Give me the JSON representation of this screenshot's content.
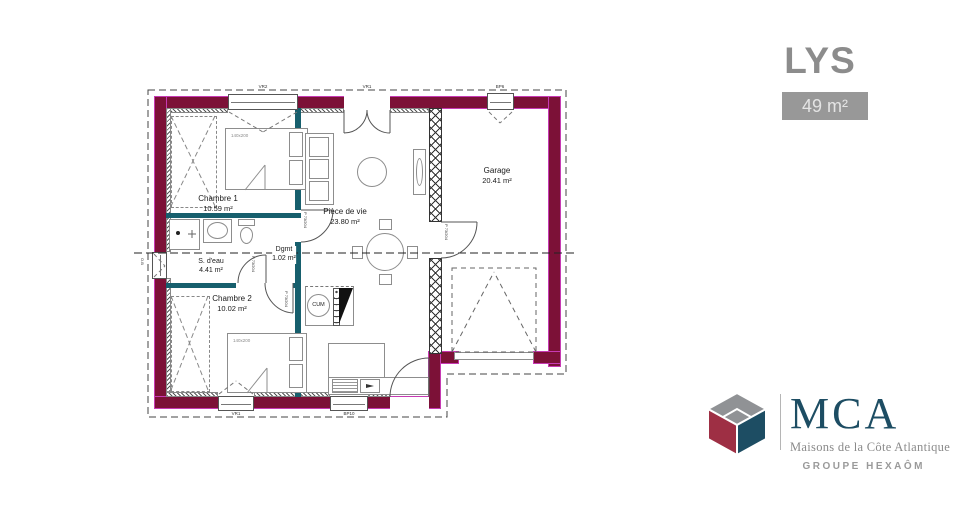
{
  "header": {
    "title": "LYS",
    "area_badge": "49 m²"
  },
  "plan": {
    "rooms": [
      {
        "name": "Chambre 1",
        "area": "10.59 m²"
      },
      {
        "name": "Pièce de vie",
        "area": "23.80 m²"
      },
      {
        "name": "Garage",
        "area": "20.41 m²"
      },
      {
        "name": "S. d'eau",
        "area": "4.41 m²"
      },
      {
        "name": "Dgmt",
        "area": "1.02 m²"
      },
      {
        "name": "Chambre 2",
        "area": "10.02 m²"
      }
    ],
    "door_code": "P 73/204",
    "bed_size": "140x200",
    "water_heater_label": "CUM",
    "window_codes": {
      "bedroom1_top": "VR2",
      "living_top": "VR1",
      "garage_top": "BP6",
      "bedroom2_bottom": "VR1",
      "kitchen_bottom": "BP10",
      "bathroom_left": "O.B"
    }
  },
  "brand": {
    "name": "MCA",
    "tagline": "Maisons de la Côte Atlantique",
    "group": "GROUPE HEXAÔM"
  },
  "colors": {
    "wall": "#7c1137",
    "wall_edge": "#c73ab4",
    "partition": "#175f6d",
    "brand_navy": "#1d4d63",
    "brand_red": "#9e2f44",
    "brand_gray": "#909295",
    "title_gray": "#8c8c8c",
    "badge_bg": "#989898"
  }
}
